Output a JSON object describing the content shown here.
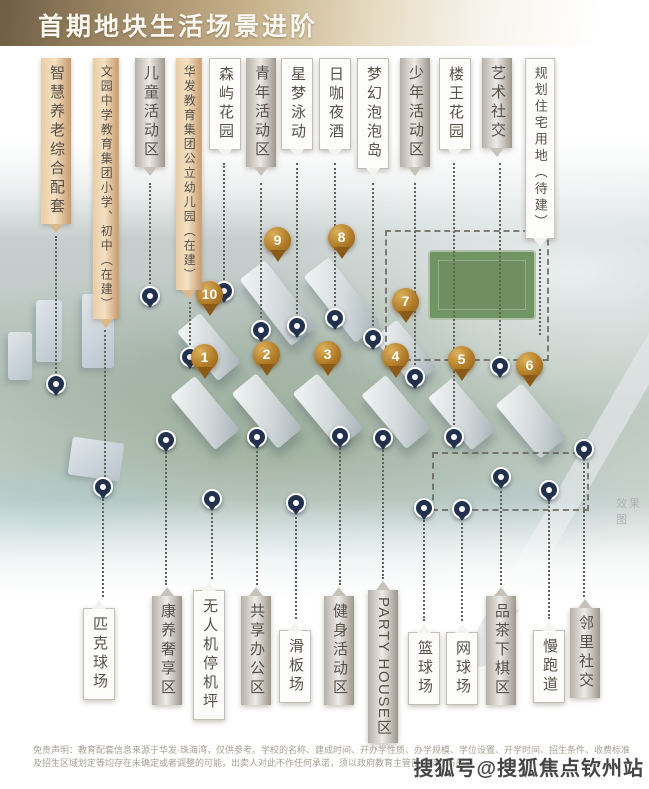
{
  "title": "首期地块生活场景进阶",
  "render_note": "效果图",
  "watermark": "搜狐号@搜狐焦点钦州站",
  "disclaimer": {
    "line1": "免责声明：教育配套信息来源于华发·珠海湾，仅供参考。学校的名称、建成时间、开办学性质、办学规模、学位设置、开学时间、招生条件、收费标准",
    "line2": "及招生区域划定等均存在未确定或者调整的可能，出卖人对此不作任何承诺，须以政府教育主管部门及校方的最"
  },
  "colors": {
    "banner_gold": "#b49c78",
    "callout_tan": "#e9cda5",
    "callout_silver": "#cdc9c2",
    "pin_gold": "#b27c28",
    "pin_navy": "#22324e"
  },
  "map": {
    "top_callouts": [
      {
        "label": "智慧养老综合配套",
        "style": "tan",
        "x": 56,
        "top": 58,
        "lx": 56,
        "l1": 236,
        "l2": 377,
        "pin": 384
      },
      {
        "label": "文园中学教育集团小学、初中（在建）",
        "style": "tan sm",
        "x": 106,
        "top": 58,
        "lx": 105,
        "l1": 330,
        "l2": 477,
        "pin": null
      },
      {
        "label": "儿童活动区",
        "style": "silver",
        "x": 150,
        "top": 58,
        "lx": 150,
        "l1": 183,
        "l2": 288,
        "pin": 296
      },
      {
        "label": "华发教育集团公立幼儿园（在建）",
        "style": "tan sm",
        "x": 189,
        "top": 58,
        "lx": 190,
        "l1": 302,
        "l2": 349,
        "pin": 357
      },
      {
        "label": "森屿花园",
        "style": "white",
        "x": 225,
        "top": 58,
        "lx": 224,
        "l1": 163,
        "l2": 283,
        "pin": 291
      },
      {
        "label": "青年活动区",
        "style": "silver",
        "x": 261,
        "top": 58,
        "lx": 261,
        "l1": 183,
        "l2": 322,
        "pin": 330
      },
      {
        "label": "星梦泳动",
        "style": "white",
        "x": 297,
        "top": 58,
        "lx": 297,
        "l1": 163,
        "l2": 318,
        "pin": 326
      },
      {
        "label": "日咖夜酒",
        "style": "white",
        "x": 335,
        "top": 58,
        "lx": 335,
        "l1": 163,
        "l2": 310,
        "pin": 318
      },
      {
        "label": "梦幻泡泡岛",
        "style": "white",
        "x": 373,
        "top": 58,
        "lx": 373,
        "l1": 183,
        "l2": 330,
        "pin": 338
      },
      {
        "label": "少年活动区",
        "style": "silver",
        "x": 415,
        "top": 58,
        "lx": 415,
        "l1": 183,
        "l2": 369,
        "pin": 377
      },
      {
        "label": "楼王花园",
        "style": "white",
        "x": 455,
        "top": 58,
        "lx": 454,
        "l1": 163,
        "l2": 429,
        "pin": 437
      },
      {
        "label": "艺术社交",
        "style": "silver",
        "x": 497,
        "top": 58,
        "lx": 500,
        "l1": 163,
        "l2": 358,
        "pin": 366
      },
      {
        "label": "规划住宅用地（待建）",
        "style": "white md",
        "x": 540,
        "top": 58,
        "lx": 540,
        "l1": 249,
        "l2": 335,
        "pin": null
      }
    ],
    "bottom_callouts": [
      {
        "label": "匹克球场",
        "style": "white",
        "x": 99,
        "top": 608,
        "lx": 103,
        "pin": 487
      },
      {
        "label": "康养奢享区",
        "style": "silver",
        "x": 167,
        "top": 596,
        "lx": 166,
        "pin": 440
      },
      {
        "label": "无人机停机坪",
        "style": "white",
        "x": 209,
        "top": 590,
        "lx": 212,
        "pin": 499
      },
      {
        "label": "共享办公区",
        "style": "silver",
        "x": 256,
        "top": 596,
        "lx": 257,
        "pin": 437
      },
      {
        "label": "滑板场",
        "style": "white",
        "x": 295,
        "top": 630,
        "lx": 296,
        "pin": 503
      },
      {
        "label": "健身活动区",
        "style": "silver",
        "x": 339,
        "top": 596,
        "lx": 340,
        "pin": 436
      },
      {
        "label": "PARTY HOUSE区",
        "style": "silver latin",
        "x": 383,
        "top": 590,
        "lx": 383,
        "pin": 438
      },
      {
        "label": "篮球场",
        "style": "white",
        "x": 424,
        "top": 632,
        "lx": 424,
        "pin": 508
      },
      {
        "label": "网球场",
        "style": "white",
        "x": 462,
        "top": 632,
        "lx": 462,
        "pin": 509
      },
      {
        "label": "品茶下棋区",
        "style": "silver",
        "x": 501,
        "top": 596,
        "lx": 501,
        "pin": 477
      },
      {
        "label": "慢跑道",
        "style": "white",
        "x": 549,
        "top": 630,
        "lx": 549,
        "pin": 490
      },
      {
        "label": "邻里社交",
        "style": "silver",
        "x": 585,
        "top": 608,
        "lx": 584,
        "pin": 449
      }
    ],
    "numbered_pins": [
      {
        "n": "1",
        "x": 205,
        "y": 358
      },
      {
        "n": "2",
        "x": 267,
        "y": 355
      },
      {
        "n": "3",
        "x": 328,
        "y": 355
      },
      {
        "n": "4",
        "x": 396,
        "y": 357
      },
      {
        "n": "5",
        "x": 462,
        "y": 360
      },
      {
        "n": "6",
        "x": 530,
        "y": 366
      },
      {
        "n": "7",
        "x": 406,
        "y": 302
      },
      {
        "n": "8",
        "x": 342,
        "y": 238
      },
      {
        "n": "9",
        "x": 278,
        "y": 241
      },
      {
        "n": "10",
        "x": 210,
        "y": 295
      }
    ],
    "towers": [
      {
        "x": 189,
        "y": 378,
        "w": 32,
        "h": 70,
        "r": -40,
        "city": false
      },
      {
        "x": 251,
        "y": 375,
        "w": 32,
        "h": 72,
        "r": -40,
        "city": false
      },
      {
        "x": 312,
        "y": 375,
        "w": 32,
        "h": 72,
        "r": -40,
        "city": false
      },
      {
        "x": 380,
        "y": 377,
        "w": 32,
        "h": 70,
        "r": -40,
        "city": false
      },
      {
        "x": 446,
        "y": 380,
        "w": 32,
        "h": 68,
        "r": -40,
        "city": false
      },
      {
        "x": 514,
        "y": 386,
        "w": 34,
        "h": 70,
        "r": -40,
        "city": false
      },
      {
        "x": 390,
        "y": 322,
        "w": 30,
        "h": 62,
        "r": -40,
        "city": false
      },
      {
        "x": 326,
        "y": 258,
        "w": 32,
        "h": 84,
        "r": -38,
        "city": false
      },
      {
        "x": 262,
        "y": 261,
        "w": 32,
        "h": 84,
        "r": -38,
        "city": false
      },
      {
        "x": 194,
        "y": 315,
        "w": 30,
        "h": 64,
        "r": -40,
        "city": false
      },
      {
        "x": 36,
        "y": 300,
        "w": 26,
        "h": 62,
        "r": 0,
        "city": true
      },
      {
        "x": 82,
        "y": 294,
        "w": 32,
        "h": 74,
        "r": 0,
        "city": true
      },
      {
        "x": 8,
        "y": 332,
        "w": 24,
        "h": 48,
        "r": 0,
        "city": true
      },
      {
        "x": 70,
        "y": 440,
        "w": 52,
        "h": 38,
        "r": 8,
        "city": true
      }
    ],
    "field": {
      "x": 428,
      "y": 250,
      "w": 104,
      "h": 66
    },
    "boundary": [
      {
        "x": 385,
        "y": 230,
        "w": 160,
        "h": 127
      },
      {
        "x": 432,
        "y": 452,
        "w": 153,
        "h": 55
      }
    ]
  }
}
